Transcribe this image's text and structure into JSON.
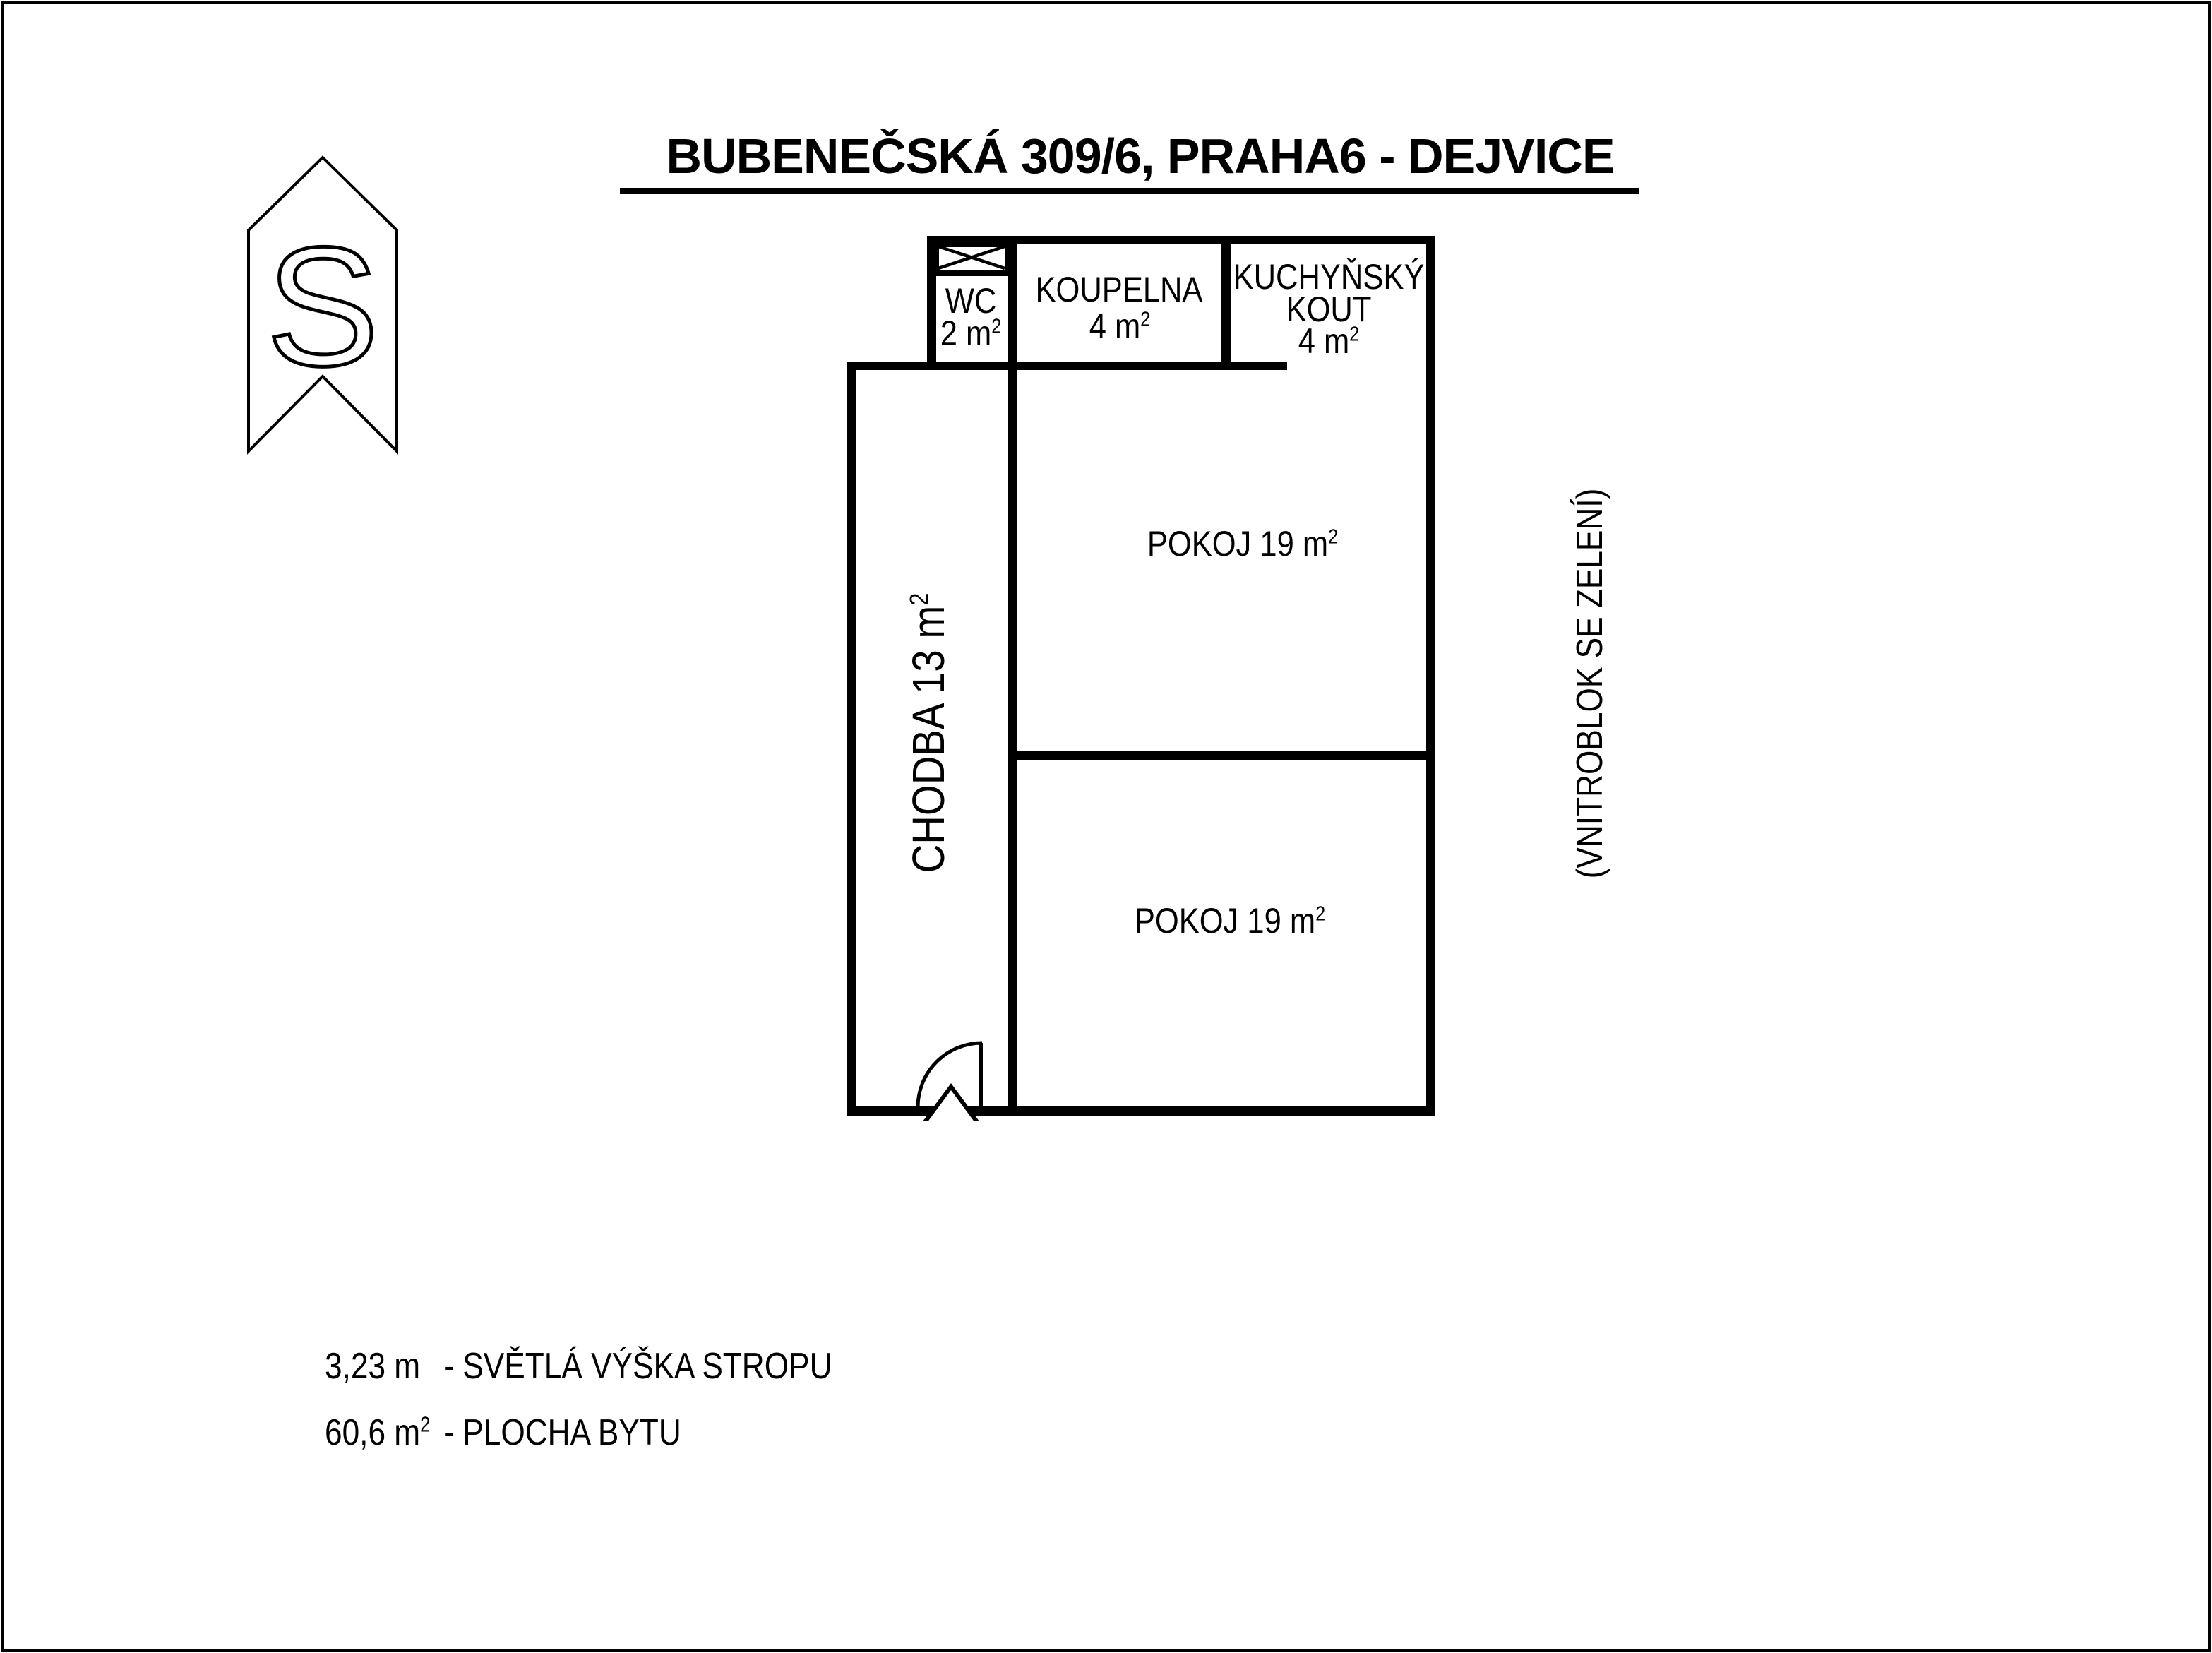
{
  "colors": {
    "ink": "#000000",
    "paper": "#ffffff"
  },
  "title": {
    "text": "BUBENEČSKÁ 309/6, PRAHA6 - DEJVICE"
  },
  "north_marker": {
    "letter": "S"
  },
  "rooms": {
    "wc": {
      "name": "WC",
      "area": "2 m",
      "sup": "2"
    },
    "koupelna": {
      "name": "KOUPELNA",
      "area": "4 m",
      "sup": "2"
    },
    "kuchynsky_kout": {
      "line1": "KUCHYŇSKÝ",
      "line2": "KOUT",
      "area": "4 m",
      "sup": "2"
    },
    "pokoj_top": {
      "label": "POKOJ 19 m",
      "sup": "2"
    },
    "pokoj_bottom": {
      "label": "POKOJ 19 m",
      "sup": "2"
    },
    "chodba": {
      "label": "CHODBA 13 m",
      "sup": "2"
    }
  },
  "right_note": {
    "text": "(VNITROBLOK SE ZELENÍ)"
  },
  "legend": {
    "row1": {
      "value": "3,23 m",
      "value_sup": "",
      "label": "- SVĚTLÁ VÝŠKA STROPU"
    },
    "row2": {
      "value": "60,6 m",
      "value_sup": "2",
      "label": "- PLOCHA BYTU"
    }
  }
}
